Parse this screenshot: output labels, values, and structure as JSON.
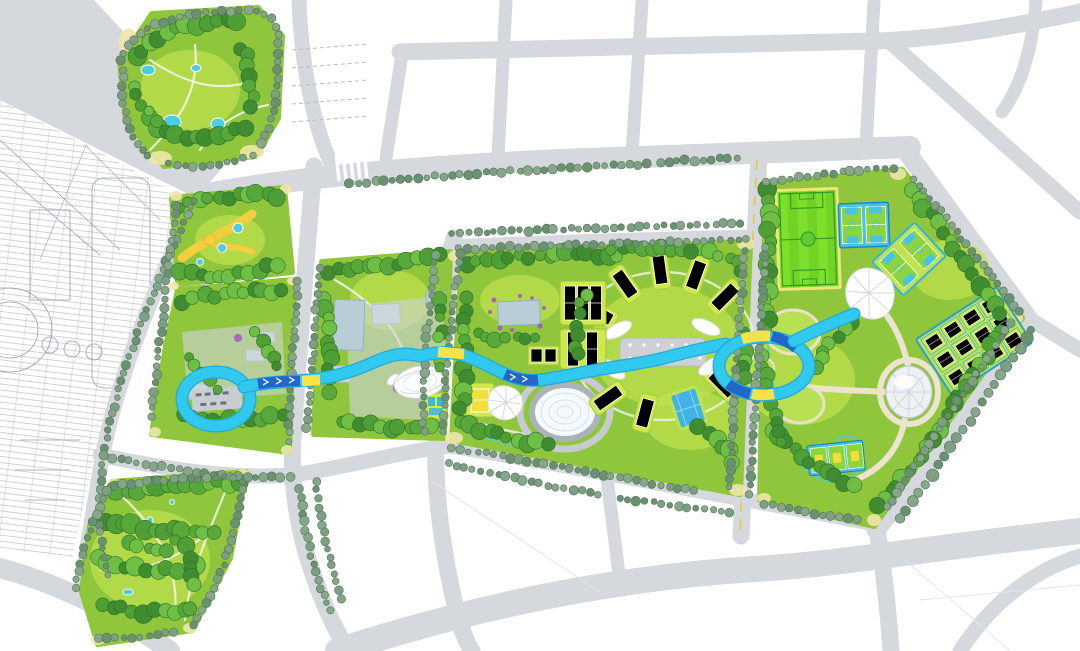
{
  "meta": {
    "title": "Riverside sports park masterplan — aerial plan rendering",
    "type": "landscape architecture masterplan",
    "description": "Top-down rendered masterplan of a linear urban sports park. A winding cyan ribbon path with two loop rings crosses six green parcels containing sports courts, ponds, domes and canopies, surrounded by gray roads, white city blocks and a CAD line drawing of the adjacent site on the left."
  },
  "palette": {
    "road": "#d5d8dc",
    "block": "#ffffff",
    "park_base": "#8fc63c",
    "park_light": "#c0e24d",
    "plaza_gray": "#d0d4d8",
    "plaza_beige": "#ece4cf",
    "canopy_white": "#ffffff",
    "water": "#b9cdd6",
    "pool_cyan": "#49cfe0",
    "court_lime": "#cfe84a",
    "court_green": "#8ed53c",
    "court_blue": "#3fb3e8",
    "soccer_green": "#7fe02b",
    "soccer_stripe": "#72d226",
    "soccer_line": "#2f9e27",
    "basket_blue": "#49c2e8",
    "ribbon_cyan": "#32c9f0",
    "ribbon_blue": "#2366c9",
    "ribbon_yellow": "#f5e449",
    "flower_purple": "#a857c2",
    "cad_line": "#9aa1a8",
    "yellow_path": "#f2cf3e",
    "tree_fills": [
      "#3f8c31",
      "#58a83c",
      "#4f9f36",
      "#6fbf45"
    ],
    "tree_stroke": "#2f6e27",
    "street_tree_fills": [
      "#7d9f82",
      "#6b9270",
      "#86a78a"
    ],
    "street_tree_stroke": "#566f5c"
  },
  "features": [
    {
      "id": "cad-site-drawing",
      "label": "adjacent site CAD line drawing"
    },
    {
      "id": "road-network",
      "label": "city road network"
    },
    {
      "id": "city-blocks",
      "label": "white development blocks"
    },
    {
      "id": "northwest-park",
      "label": "north-west woodland park parcel"
    },
    {
      "id": "playground-parcel",
      "label": "playground parcel with yellow paths"
    },
    {
      "id": "plaza-parcel",
      "label": "plaza parcel with pavilions"
    },
    {
      "id": "southwest-park",
      "label": "south-west woodland park parcel"
    },
    {
      "id": "pond-parcel",
      "label": "central-west parcel with ponds and plazas"
    },
    {
      "id": "central-activity-parcel",
      "label": "central parcel with petal court cluster"
    },
    {
      "id": "sports-parcel",
      "label": "eastern sports parcel"
    },
    {
      "id": "blue-ribbon",
      "label": "elevated cyan ribbon loop path"
    },
    {
      "id": "west-loop-ring",
      "label": "western ribbon loop ring"
    },
    {
      "id": "east-loop-ring",
      "label": "eastern ribbon loop ring"
    },
    {
      "id": "soccer-field",
      "label": "striped soccer field"
    },
    {
      "id": "basketball-courts",
      "label": "paired basketball courts"
    },
    {
      "id": "angled-courts",
      "label": "rotated court pair"
    },
    {
      "id": "court-grid",
      "label": "3x4 grid of small courts"
    },
    {
      "id": "small-court-row",
      "label": "row of three small courts"
    },
    {
      "id": "geodesic-dome",
      "label": "faceted dome pavilion"
    },
    {
      "id": "leaf-canopy",
      "label": "white leaf-shaped canopy"
    },
    {
      "id": "flower-canopy",
      "label": "white radial flower canopy"
    },
    {
      "id": "shell-pavilion",
      "label": "white ribbed shell pavilion"
    },
    {
      "id": "petal-court-cluster",
      "label": "radial petal court cluster"
    },
    {
      "id": "mosaic-oval-plaza",
      "label": "oval mosaic plaza"
    },
    {
      "id": "rect-pond",
      "label": "rectangular pond with purple planting"
    },
    {
      "id": "tennis-court-block",
      "label": "tennis court blocks"
    },
    {
      "id": "yellow-court",
      "label": "yellow games court"
    },
    {
      "id": "crosswalk",
      "label": "zebra crosswalk"
    }
  ]
}
